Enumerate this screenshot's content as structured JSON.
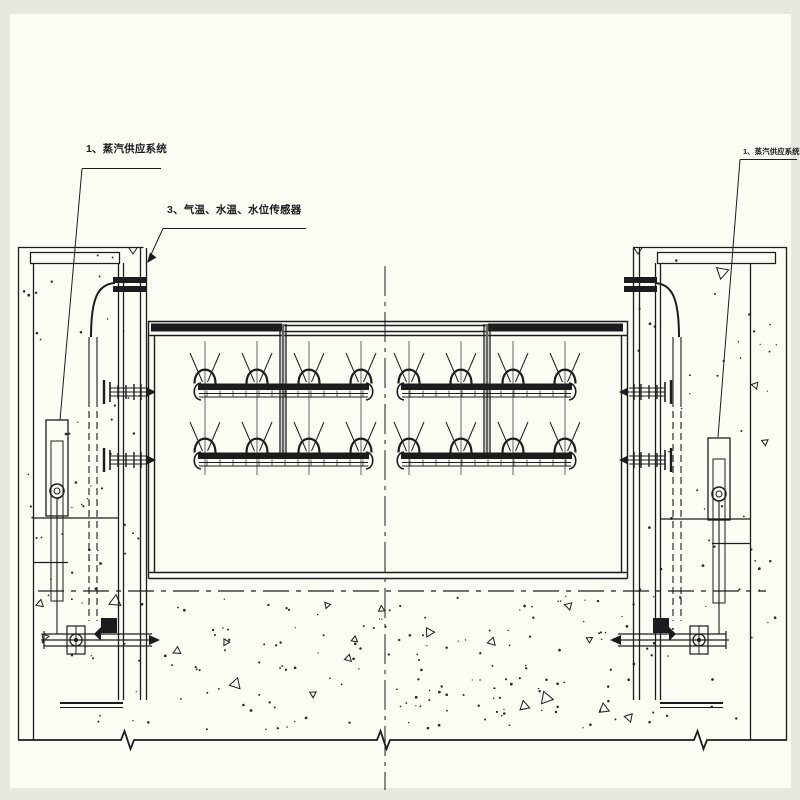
{
  "page": {
    "paper_color": "#fbfcf4",
    "margin_color": "#e7e9e0",
    "line_color": "#1c1c1e"
  },
  "labels": {
    "steam_left": {
      "index": "1",
      "text": "1、蒸汽供应系统"
    },
    "sensors": {
      "index": "3",
      "text": "3、气温、水温、水位传感器"
    },
    "steam_right": {
      "index": "1",
      "text": "1、蒸汽供应系统"
    }
  },
  "heating": {
    "rows_y": [
      383,
      452
    ],
    "groups": [
      {
        "x1": 193,
        "x2": 374,
        "nozzles": [
          205,
          257,
          309,
          361
        ]
      },
      {
        "x1": 396,
        "x2": 577,
        "nozzles": [
          409,
          461,
          513,
          565
        ]
      }
    ],
    "feed_pipes_x": [
      283,
      487
    ],
    "nozzle_columns_span": [
      341,
      475
    ]
  },
  "texture": {
    "foundation": {
      "x": 136,
      "y": 596,
      "w": 510,
      "h": 134,
      "dots": 150,
      "triangles": 16,
      "seed": 7
    },
    "left_pier": {
      "x": 21,
      "y": 255,
      "w": 122,
      "h": 474,
      "dots": 60,
      "triangles": 3,
      "seed": 11
    },
    "right_pier": {
      "x": 637,
      "y": 255,
      "w": 146,
      "h": 474,
      "dots": 60,
      "triangles": 3,
      "seed": 23
    }
  }
}
